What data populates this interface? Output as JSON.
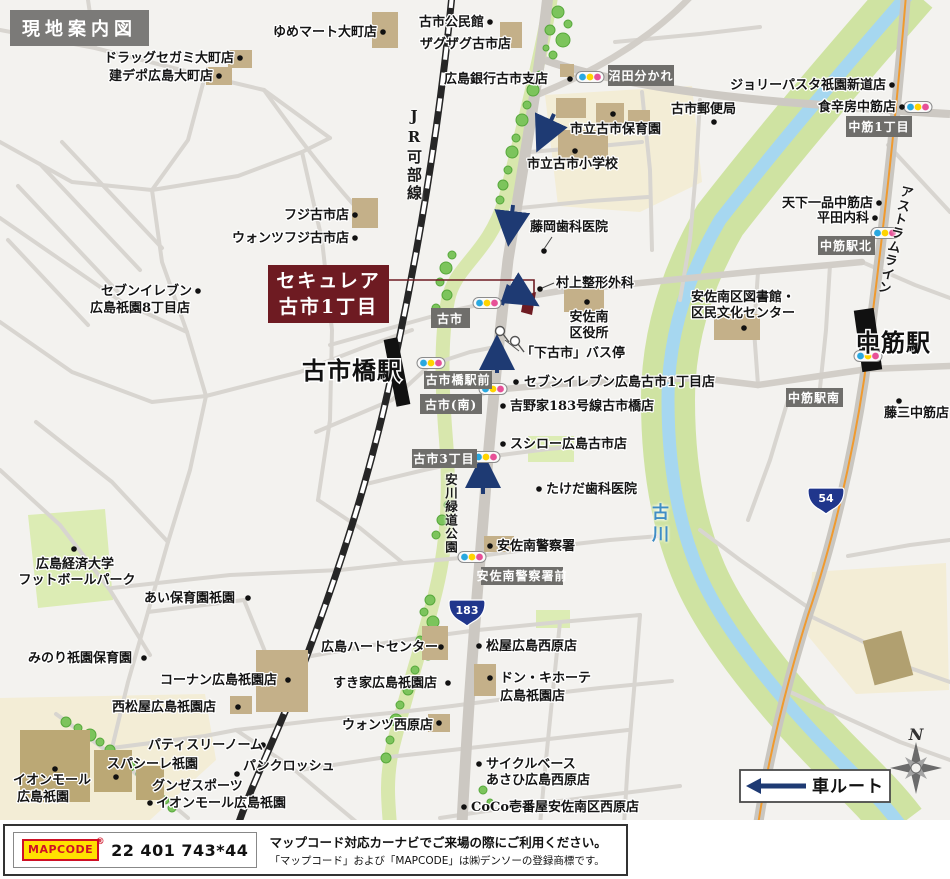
{
  "title": "現地案内図",
  "property": {
    "line1": "セキュレア",
    "line2": "古市1丁目"
  },
  "stations": {
    "furuichibashi": "古市橋駅",
    "nakasuji": "中筋駅"
  },
  "lines": {
    "jr": "JR可部線",
    "astram": "アストラムライン"
  },
  "river": {
    "name": "古川"
  },
  "park": {
    "name": "安川緑道公園"
  },
  "shields": {
    "r183": "183",
    "r54": "54"
  },
  "badges": [
    {
      "t": "沼田分かれ"
    },
    {
      "t": "中筋1丁目"
    },
    {
      "t": "中筋駅北"
    },
    {
      "t": "中筋駅南"
    },
    {
      "t": "古市"
    },
    {
      "t": "古市橋駅前"
    },
    {
      "t": "古市(南)"
    },
    {
      "t": "古市3丁目"
    },
    {
      "t": "安佐南警察署前"
    }
  ],
  "labels": [
    {
      "t": "ドラッグセガミ大町店"
    },
    {
      "t": "建デポ広島大町店"
    },
    {
      "t": "ゆめマート大町店"
    },
    {
      "t": "古市公民館"
    },
    {
      "t": "ザグザグ古市店"
    },
    {
      "t": "広島銀行古市支店"
    },
    {
      "t": "市立古市保育園"
    },
    {
      "t": "市立古市小学校"
    },
    {
      "t": "古市郵便局"
    },
    {
      "t": "ジョリーパスタ祇園新道店"
    },
    {
      "t": "食辛房中筋店"
    },
    {
      "t": "天下一品中筋店"
    },
    {
      "t": "平田内科"
    },
    {
      "t": "フジ古市店"
    },
    {
      "t": "ウォンツフジ古市店"
    },
    {
      "t": "セブンイレブン"
    },
    {
      "t": "広島祇園8丁目店"
    },
    {
      "t": "藤岡歯科医院"
    },
    {
      "t": "村上整形外科"
    },
    {
      "t": "安佐南"
    },
    {
      "t": "区役所"
    },
    {
      "t": "「下古市」バス停"
    },
    {
      "t": "セブンイレブン広島古市1丁目店"
    },
    {
      "t": "吉野家183号線古市橋店"
    },
    {
      "t": "スシロー広島古市店"
    },
    {
      "t": "たけだ歯科医院"
    },
    {
      "t": "安佐南区図書館・"
    },
    {
      "t": "区民文化センター"
    },
    {
      "t": "藤三中筋店"
    },
    {
      "t": "広島経済大学"
    },
    {
      "t": "フットボールパーク"
    },
    {
      "t": "あい保育園祇園"
    },
    {
      "t": "みのり祇園保育園"
    },
    {
      "t": "コーナン広島祇園店"
    },
    {
      "t": "西松屋広島祇園店"
    },
    {
      "t": "パティスリーノーム"
    },
    {
      "t": "スパシーレ祇園"
    },
    {
      "t": "パンクロッシュ"
    },
    {
      "t": "イオンモール"
    },
    {
      "t": "広島祇園"
    },
    {
      "t": "グンゼスポーツ"
    },
    {
      "t": "イオンモール広島祇園"
    },
    {
      "t": "広島ハートセンター"
    },
    {
      "t": "松屋広島西原店"
    },
    {
      "t": "すき家広島祇園店"
    },
    {
      "t": "ドン・キホーテ"
    },
    {
      "t": "広島祇園店"
    },
    {
      "t": "ウォンツ西原店"
    },
    {
      "t": "サイクルベース"
    },
    {
      "t": "あさひ広島西原店"
    },
    {
      "t": "CoCo壱番屋安佐南区西原店"
    },
    {
      "t": "安佐南警察署"
    }
  ],
  "legend": {
    "car_route": "車ルート",
    "north": "N"
  },
  "footer": {
    "logo": "MAPCODE",
    "reg": "®",
    "code": "22 401 743*44",
    "note1": "マップコード対応カーナビでご来場の際にご利用ください。",
    "note2": "「マップコード」および「MAPCODE」は㈱デンソーの登録商標です。"
  }
}
